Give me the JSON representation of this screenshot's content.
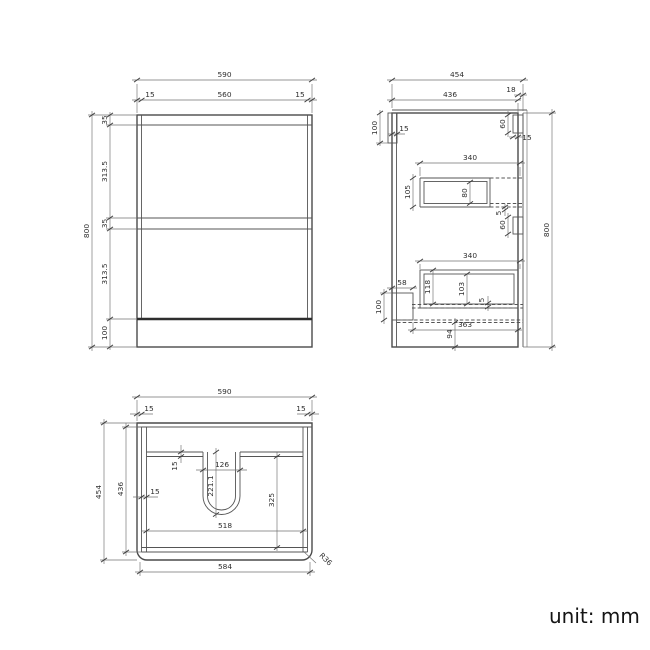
{
  "note": {
    "unit_label": "unit: mm"
  },
  "front_view": {
    "overall_width": "590",
    "side_gap_left": "15",
    "front_width": "560",
    "side_gap_right": "15",
    "overall_height": "800",
    "top_rail_height": "35",
    "drawer1_front_height": "313.5",
    "drawer_gap_height": "35",
    "drawer2_front_height": "313.5",
    "kick_height": "100"
  },
  "side_view": {
    "overall_depth": "454",
    "carcass_depth": "436",
    "front_panel_thickness": "18",
    "hanging_rail_height": "100",
    "hanging_rail_thickness": "15",
    "top_recess_height": "60",
    "top_recess_depth": "15",
    "drawer1_depth": "340",
    "drawer1_height": "105",
    "drawer1_inner_height": "80",
    "drawer1_clearance": "5",
    "mid_recess_height": "60",
    "drawer2_depth": "340",
    "drawer2_height": "118",
    "drawer2_inner_height": "103",
    "drawer2_clearance": "5",
    "rear_notch_depth": "58",
    "rear_notch_height": "100",
    "bottom_panel_depth": "363",
    "bottom_clearance": "94",
    "overall_height": "800"
  },
  "plan_view": {
    "overall_width": "590",
    "side_overhang_left": "15",
    "side_overhang_right": "15",
    "overall_depth": "454",
    "carcass_depth": "436",
    "back_rail_thickness": "15",
    "cutout_width": "126",
    "cutout_depth": "221.1",
    "side_panel_thickness": "15",
    "inner_depth": "325",
    "inner_width": "518",
    "front_edge_width": "584",
    "corner_radius": "R36"
  },
  "colors": {
    "line": "#4a4a4a",
    "dim": "#707070",
    "text": "#2e2e2e"
  }
}
